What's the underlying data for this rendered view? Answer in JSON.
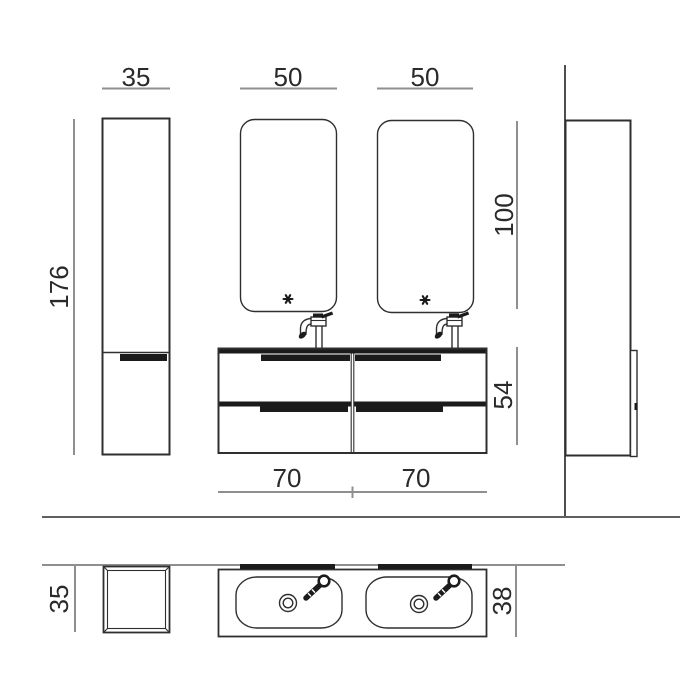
{
  "title": "Bathroom vanity composition technical drawing",
  "colors": {
    "bg": "#ffffff",
    "line": "#2f2f2f",
    "ink": "#1b1b1b",
    "dim": "#8f8f8f",
    "wall": "#8f8f8f",
    "wall_strong": "#3a3a3a",
    "separator": "#5f5f5f",
    "text": "#2a2a2a"
  },
  "dimensions": {
    "front": {
      "column_width": "35",
      "left_mirror_width": "50",
      "right_mirror_width": "50",
      "column_height": "176",
      "mirror_height": "100",
      "vanity_height": "54",
      "left_module_width": "70",
      "right_module_width": "70"
    },
    "plan": {
      "column_depth": "35",
      "countertop_depth": "38"
    }
  },
  "icons": {
    "mirror_sensor": "touch-sensor-asterisk",
    "faucet_front": "single-lever-tall-faucet-side",
    "faucet_plan": "faucet-top-view",
    "drain_plan": "drain-double-circle"
  },
  "components": {
    "tall_column_front": "tall side cabinet, front view",
    "tall_column_side": "tall side cabinet, side view against wall",
    "mirrors": "two rounded-corner mirrors",
    "vanity": "double washbasin unit with four drawers",
    "plan_view": "top view with column footprint and double-basin countertop"
  }
}
